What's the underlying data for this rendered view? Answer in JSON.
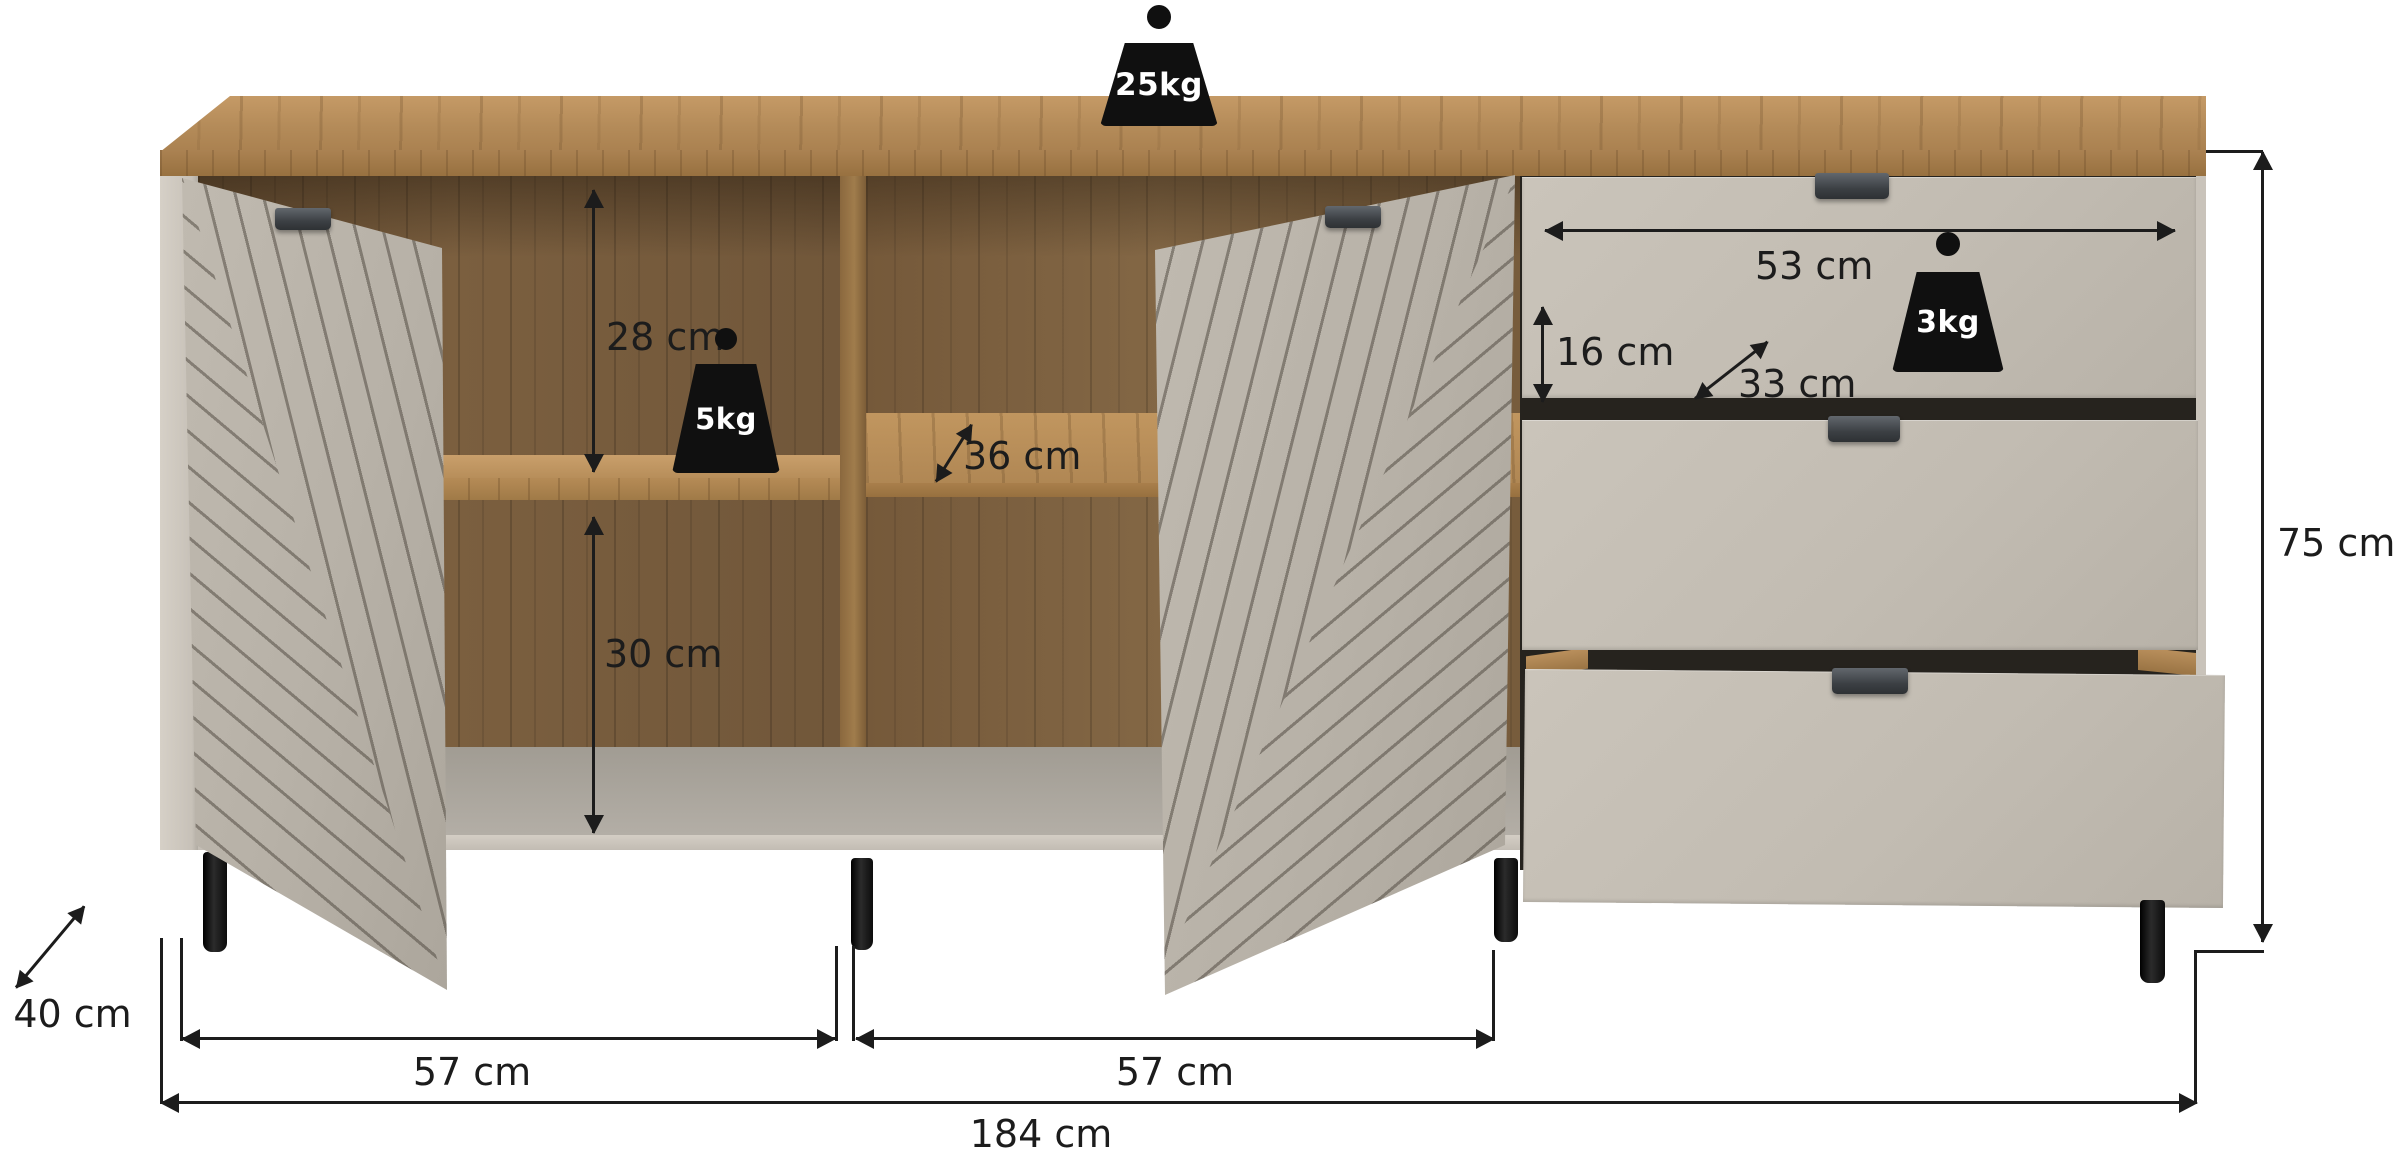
{
  "diagram": {
    "type": "furniture-dimension-diagram",
    "product": "sideboard with two grooved doors and three drawers",
    "units": "cm"
  },
  "weights": {
    "top_load": "25kg",
    "shelf_load": "5kg",
    "drawer_load": "3kg"
  },
  "dimensions": {
    "upper_compartment_height": "28 cm",
    "lower_compartment_height": "30 cm",
    "shelf_depth": "36 cm",
    "drawer_width": "53 cm",
    "drawer_height": "16 cm",
    "drawer_depth": "33 cm",
    "total_height": "75 cm",
    "total_depth": "40 cm",
    "left_section_width": "57 cm",
    "middle_section_width": "57 cm",
    "total_width": "184 cm"
  },
  "colors": {
    "background": "#ffffff",
    "wood_top": "#b48b59",
    "wood_interior": "#7b5f3f",
    "front_greige": "#c2bcb2",
    "side_panel": "#cfc9c0",
    "handle": "#3c4044",
    "leg": "#161616",
    "annotation": "#1c1c1c"
  }
}
